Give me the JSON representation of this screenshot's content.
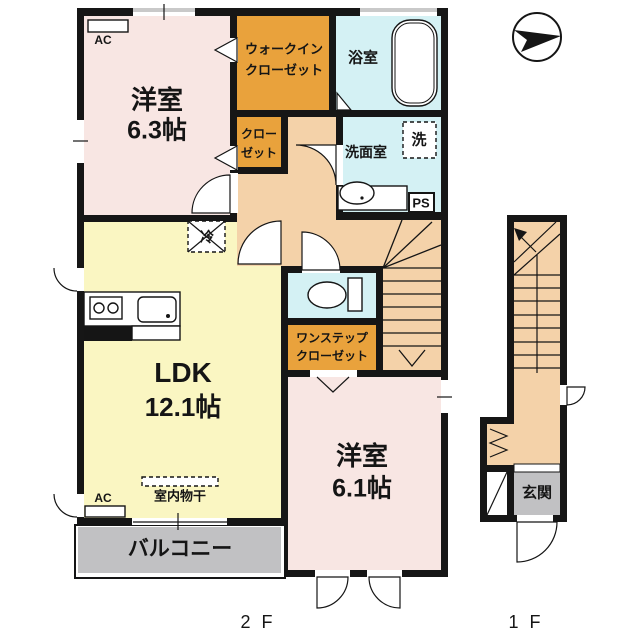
{
  "title": "floor-plan",
  "labels": {
    "room_63_line1": "洋室",
    "room_63_line2": "6.3帖",
    "wic_line1": "ウォークイン",
    "wic_line2": "クローゼット",
    "bath": "浴室",
    "closet_line1": "クロー",
    "closet_line2": "ゼット",
    "washroom": "洗面室",
    "washer": "洗",
    "ps": "PS",
    "fridge": "冷",
    "ldk_line1": "LDK",
    "ldk_line2": "12.1帖",
    "onestep_line1": "ワンステップ",
    "onestep_line2": "クローゼット",
    "indoor_drying": "室内物干",
    "ac_top": "AC",
    "ac_bottom": "AC",
    "balcony": "バルコニー",
    "room_61_line1": "洋室",
    "room_61_line2": "6.1帖",
    "entrance": "玄関",
    "floor_2f": "2 F",
    "floor_1f": "1 F"
  },
  "colors": {
    "wall": "#161616",
    "western_room": "#f8e6e3",
    "ldk": "#faf6c2",
    "closet_orange": "#e9a23c",
    "wet_area": "#d4f1f4",
    "hallway": "#f4d2a9",
    "balcony_gray": "#c1c1c3",
    "window_gray": "#c9c9c9"
  }
}
